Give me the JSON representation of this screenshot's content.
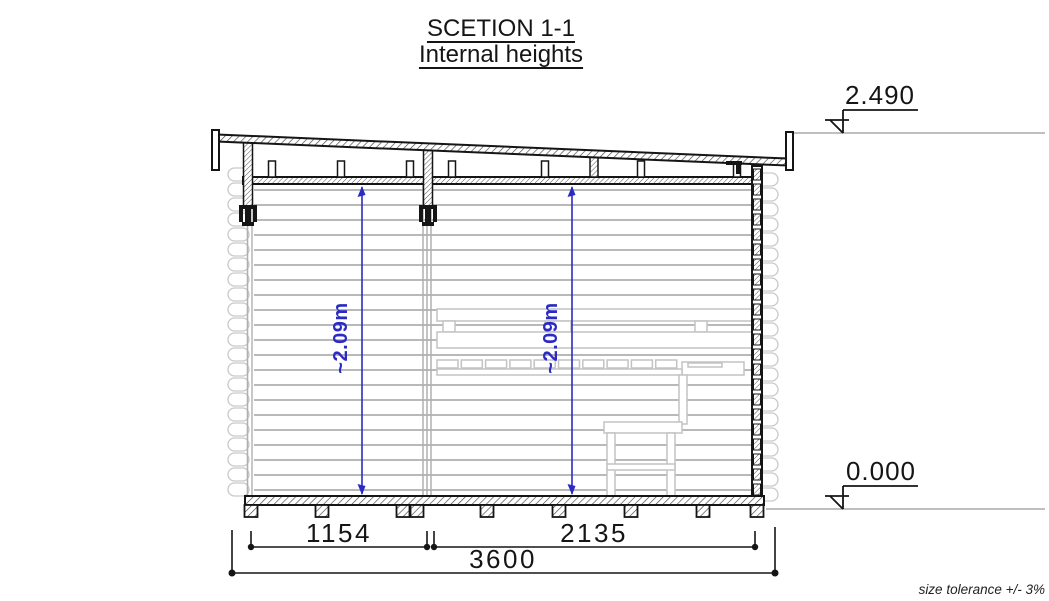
{
  "title": {
    "line1": "SCETION 1-1",
    "line2": "Internal heights"
  },
  "levels": {
    "top": "2.490",
    "bottom": "0.000"
  },
  "dimensions": {
    "internal_height_left": "~2.09m",
    "internal_height_right": "~2.09m",
    "left_room_width_mm": "1154",
    "right_room_width_mm": "2135",
    "total_width_mm": "3600"
  },
  "note": "size tolerance +/- 3%",
  "colors": {
    "line_black": "#151515",
    "log_gray": "#b9b9b9",
    "log_end_gray": "#c9c9c9",
    "bench_gray": "#c3c3c3",
    "dimension_blue": "#2b2bc4",
    "level_line_gray": "#aaaaaa"
  }
}
